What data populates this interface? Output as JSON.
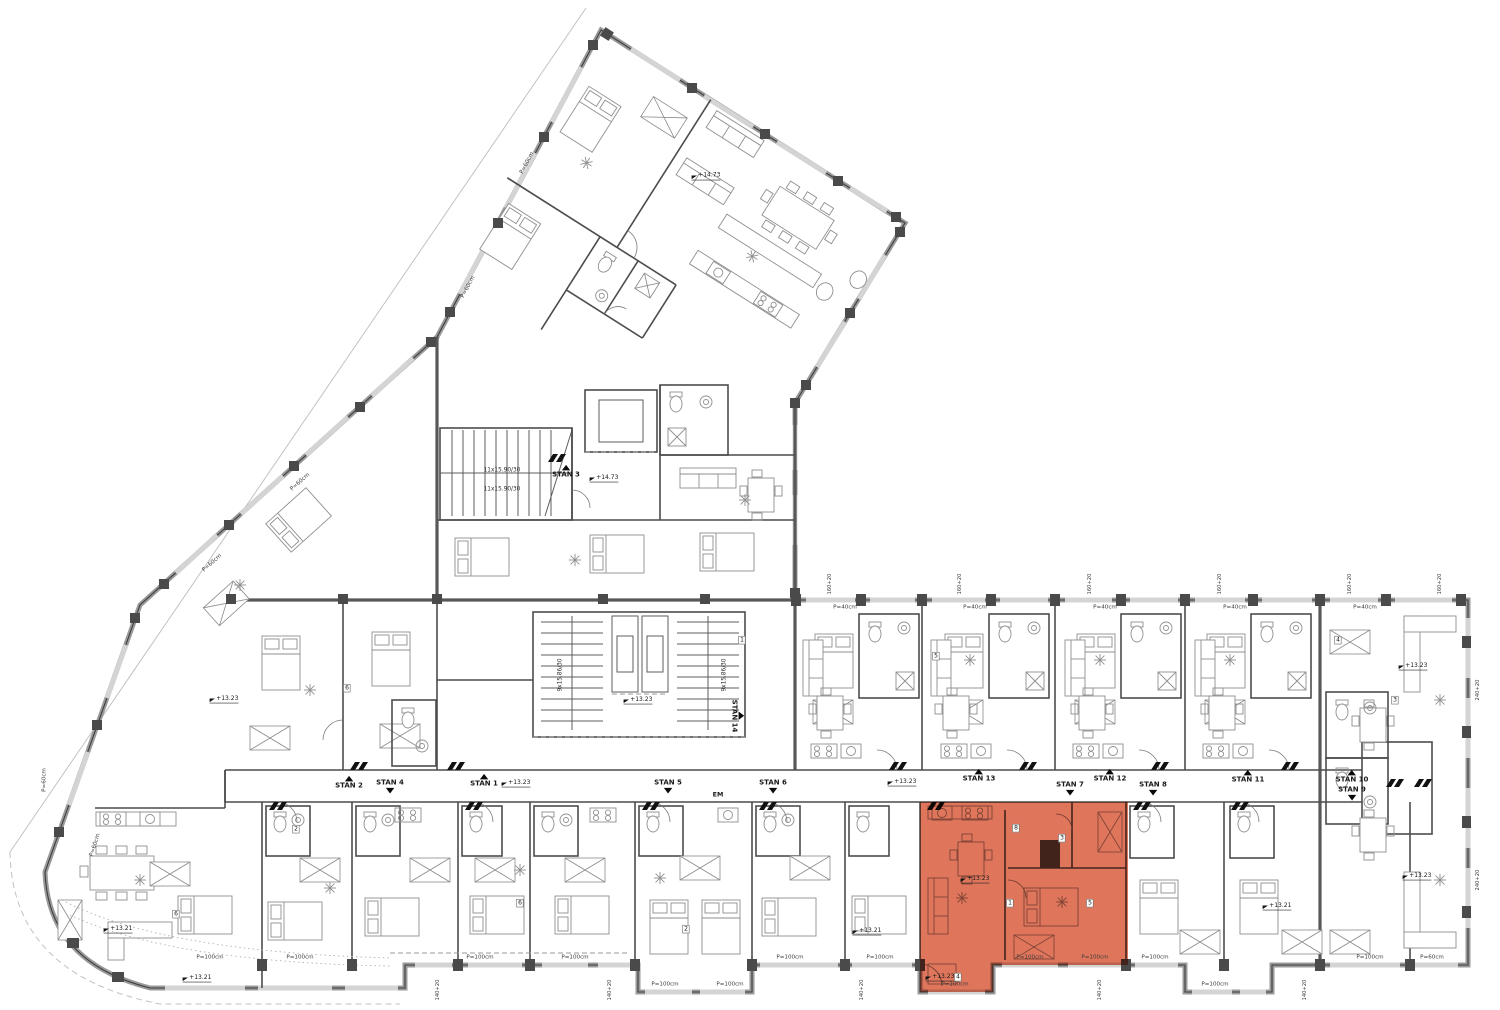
{
  "colors": {
    "highlight": "#DE6F53",
    "wall": "#4c4c4c",
    "structure": "#585858",
    "window": "#d4d4d4",
    "furniture": "#8f8f8f"
  },
  "highlight": {
    "apartment": "STAN 7"
  },
  "markers": [
    {
      "t": "stan",
      "text": "STAN 1",
      "x": 484,
      "y": 781,
      "dir": "up"
    },
    {
      "t": "stan",
      "text": "STAN 2",
      "x": 349,
      "y": 783,
      "dir": "up"
    },
    {
      "t": "stan",
      "text": "STAN 3",
      "x": 566,
      "y": 472,
      "dir": "up"
    },
    {
      "t": "stan",
      "text": "STAN 4",
      "x": 390,
      "y": 786,
      "dir": "down"
    },
    {
      "t": "stan",
      "text": "STAN 5",
      "x": 668,
      "y": 786,
      "dir": "down"
    },
    {
      "t": "stan",
      "text": "STAN 6",
      "x": 773,
      "y": 786,
      "dir": "down"
    },
    {
      "t": "stan",
      "text": "STAN 7",
      "x": 1070,
      "y": 788,
      "dir": "down"
    },
    {
      "t": "stan",
      "text": "STAN 8",
      "x": 1153,
      "y": 788,
      "dir": "down"
    },
    {
      "t": "stan",
      "text": "STAN 9",
      "x": 1352,
      "y": 793,
      "dir": "down"
    },
    {
      "t": "stan",
      "text": "STAN 10",
      "x": 1352,
      "y": 777,
      "dir": "up"
    },
    {
      "t": "stan",
      "text": "STAN 11",
      "x": 1248,
      "y": 777,
      "dir": "up"
    },
    {
      "t": "stan",
      "text": "STAN 12",
      "x": 1110,
      "y": 776,
      "dir": "up"
    },
    {
      "t": "stan",
      "text": "STAN 13",
      "x": 979,
      "y": 776,
      "dir": "up"
    },
    {
      "t": "stan",
      "text": "STAN 14",
      "x": 737,
      "y": 716,
      "dir": "up",
      "rot": 90
    },
    {
      "t": "elev",
      "text": "+14.73",
      "x": 706,
      "y": 176
    },
    {
      "t": "elev",
      "text": "+14.73",
      "x": 604,
      "y": 478
    },
    {
      "t": "elev",
      "text": "+13.23",
      "x": 638,
      "y": 700
    },
    {
      "t": "elev",
      "text": "+13.23",
      "x": 516,
      "y": 783
    },
    {
      "t": "elev",
      "text": "+13.23",
      "x": 902,
      "y": 782
    },
    {
      "t": "elev",
      "text": "+13.23",
      "x": 224,
      "y": 699
    },
    {
      "t": "elev",
      "text": "+13.23",
      "x": 975,
      "y": 879
    },
    {
      "t": "elev",
      "text": "+13.23",
      "x": 1413,
      "y": 666
    },
    {
      "t": "elev",
      "text": "+13.23",
      "x": 1417,
      "y": 876
    },
    {
      "t": "elev",
      "text": "+13.23",
      "x": 940,
      "y": 977
    },
    {
      "t": "elev",
      "text": "+13.21",
      "x": 118,
      "y": 929
    },
    {
      "t": "elev",
      "text": "+13.21",
      "x": 197,
      "y": 978
    },
    {
      "t": "elev",
      "text": "+13.21",
      "x": 1277,
      "y": 906
    },
    {
      "t": "elev",
      "text": "+13.21",
      "x": 867,
      "y": 931
    },
    {
      "t": "sill",
      "text": "P=100cm",
      "x": 210,
      "y": 957
    },
    {
      "t": "sill",
      "text": "P=100cm",
      "x": 300,
      "y": 957
    },
    {
      "t": "sill",
      "text": "P=100cm",
      "x": 480,
      "y": 957
    },
    {
      "t": "sill",
      "text": "P=100cm",
      "x": 575,
      "y": 957
    },
    {
      "t": "sill",
      "text": "P=100cm",
      "x": 665,
      "y": 984
    },
    {
      "t": "sill",
      "text": "P=100cm",
      "x": 730,
      "y": 984
    },
    {
      "t": "sill",
      "text": "P=100cm",
      "x": 790,
      "y": 957
    },
    {
      "t": "sill",
      "text": "P=100cm",
      "x": 880,
      "y": 957
    },
    {
      "t": "sill",
      "text": "P=100cm",
      "x": 955,
      "y": 984
    },
    {
      "t": "sill",
      "text": "P=100cm",
      "x": 1030,
      "y": 957
    },
    {
      "t": "sill",
      "text": "P=100cm",
      "x": 1095,
      "y": 957
    },
    {
      "t": "sill",
      "text": "P=100cm",
      "x": 1155,
      "y": 957
    },
    {
      "t": "sill",
      "text": "P=100cm",
      "x": 1215,
      "y": 984
    },
    {
      "t": "sill",
      "text": "P=100cm",
      "x": 1370,
      "y": 957
    },
    {
      "t": "sill",
      "text": "P=60cm",
      "x": 1432,
      "y": 957
    },
    {
      "t": "sill",
      "text": "P=40cm",
      "x": 845,
      "y": 607
    },
    {
      "t": "sill",
      "text": "P=40cm",
      "x": 975,
      "y": 607
    },
    {
      "t": "sill",
      "text": "P=40cm",
      "x": 1105,
      "y": 607
    },
    {
      "t": "sill",
      "text": "P=40cm",
      "x": 1235,
      "y": 607
    },
    {
      "t": "sill",
      "text": "P=40cm",
      "x": 1365,
      "y": 607
    },
    {
      "t": "sill",
      "text": "P=60cm",
      "x": 300,
      "y": 482,
      "rot": -42
    },
    {
      "t": "sill",
      "text": "P=60cm",
      "x": 212,
      "y": 563,
      "rot": -42
    },
    {
      "t": "sill",
      "text": "P=60cm",
      "x": 527,
      "y": 163,
      "rot": -62
    },
    {
      "t": "sill",
      "text": "P=60cm",
      "x": 468,
      "y": 287,
      "rot": -62
    },
    {
      "t": "sill",
      "text": "P=60cm",
      "x": 95,
      "y": 845,
      "rot": -72
    },
    {
      "t": "sill",
      "text": "P=60cm",
      "x": 44,
      "y": 780,
      "rot": -90
    },
    {
      "t": "dim",
      "text": "140+20",
      "x": 438,
      "y": 990,
      "rot": -90
    },
    {
      "t": "dim",
      "text": "140+20",
      "x": 610,
      "y": 990,
      "rot": -90
    },
    {
      "t": "dim",
      "text": "140+20",
      "x": 862,
      "y": 990,
      "rot": -90
    },
    {
      "t": "dim",
      "text": "140+20",
      "x": 1100,
      "y": 990,
      "rot": -90
    },
    {
      "t": "dim",
      "text": "140+20",
      "x": 1305,
      "y": 990,
      "rot": -90
    },
    {
      "t": "dim",
      "text": "160+20",
      "x": 830,
      "y": 584,
      "rot": -90
    },
    {
      "t": "dim",
      "text": "160+20",
      "x": 960,
      "y": 584,
      "rot": -90
    },
    {
      "t": "dim",
      "text": "160+20",
      "x": 1090,
      "y": 584,
      "rot": -90
    },
    {
      "t": "dim",
      "text": "160+20",
      "x": 1220,
      "y": 584,
      "rot": -90
    },
    {
      "t": "dim",
      "text": "160+20",
      "x": 1350,
      "y": 584,
      "rot": -90
    },
    {
      "t": "dim",
      "text": "160+20",
      "x": 1440,
      "y": 584,
      "rot": -90
    },
    {
      "t": "dim",
      "text": "240+20",
      "x": 1478,
      "y": 690,
      "rot": -90
    },
    {
      "t": "dim",
      "text": "240+20",
      "x": 1478,
      "y": 880,
      "rot": -90
    },
    {
      "t": "stair",
      "text": "11x15.90/30",
      "x": 502,
      "y": 470
    },
    {
      "t": "stair",
      "text": "11x15.90/30",
      "x": 502,
      "y": 489
    },
    {
      "t": "stair",
      "text": "9x15.86/30",
      "x": 560,
      "y": 675,
      "rot": -90
    },
    {
      "t": "stair",
      "text": "9x15.86/30",
      "x": 724,
      "y": 675,
      "rot": -90
    },
    {
      "t": "em",
      "text": "EM",
      "x": 718,
      "y": 795
    },
    {
      "t": "tag",
      "text": "4",
      "x": 958,
      "y": 977
    },
    {
      "t": "tag",
      "text": "8",
      "x": 1016,
      "y": 828
    },
    {
      "t": "tag",
      "text": "3",
      "x": 1062,
      "y": 838
    },
    {
      "t": "tag",
      "text": "1",
      "x": 1010,
      "y": 903
    },
    {
      "t": "tag",
      "text": "5",
      "x": 1090,
      "y": 903
    },
    {
      "t": "tag",
      "text": "1",
      "x": 742,
      "y": 640
    },
    {
      "t": "tag",
      "text": "6",
      "x": 347,
      "y": 688
    },
    {
      "t": "tag",
      "text": "6",
      "x": 176,
      "y": 914
    },
    {
      "t": "tag",
      "text": "6",
      "x": 520,
      "y": 903
    },
    {
      "t": "tag",
      "text": "5",
      "x": 936,
      "y": 656
    },
    {
      "t": "tag",
      "text": "2",
      "x": 686,
      "y": 929
    },
    {
      "t": "tag",
      "text": "2",
      "x": 296,
      "y": 829
    },
    {
      "t": "tag",
      "text": "4",
      "x": 1338,
      "y": 640
    },
    {
      "t": "tag",
      "text": "3",
      "x": 1395,
      "y": 700
    }
  ]
}
